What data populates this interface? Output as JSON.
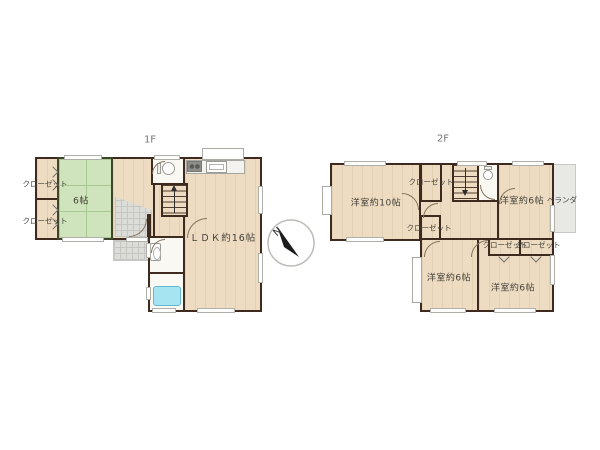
{
  "floors": {
    "f1": {
      "label": "1F",
      "rooms": {
        "closet_top": {
          "label": "クローゼット"
        },
        "closet_bottom": {
          "label": "クローゼット"
        },
        "tatami": {
          "label": "6帖"
        },
        "ldk": {
          "label": "ＬＤＫ約16帖"
        }
      }
    },
    "f2": {
      "label": "2F",
      "rooms": {
        "bedroom10": {
          "label": "洋室約10帖"
        },
        "closet_upper": {
          "label": "クローゼット"
        },
        "closet_middle": {
          "label": "クローゼット"
        },
        "bedroom6_ne": {
          "label": "洋室約6帖"
        },
        "veranda": {
          "label": "ベランダ"
        },
        "closet_se_left": {
          "label": "クローゼット"
        },
        "closet_se_right": {
          "label": "クローゼット"
        },
        "bedroom6_sw": {
          "label": "洋室約6帖"
        },
        "bedroom6_se": {
          "label": "洋室約6帖"
        }
      }
    }
  },
  "compass": {
    "north_label": "N"
  },
  "icons": {
    "compass": "circle-with-black-needle",
    "toilet": "tank-and-bowl-css-shape",
    "sink": "rounded-rect-with-oval",
    "bathtub": "blue-rounded-rect",
    "stove": "gray-rect-two-burners",
    "kitchen_sink": "white-rect-inset",
    "stairs_arrow": "line-with-triangle"
  },
  "colors": {
    "wall": "#3f2a20",
    "floor": "#eddcc1",
    "tatami": "#cfe4bc",
    "tatami_line": "#a9c792",
    "white_room": "#faf8f3",
    "tub": "#a6e4f2",
    "tub_border": "#64b8cf",
    "gray_floor": "#dcdcd8",
    "gray_line": "#c6c6c2",
    "veranda": "#e8e8e5",
    "label": "#44403a",
    "floor_label": "#757575"
  }
}
